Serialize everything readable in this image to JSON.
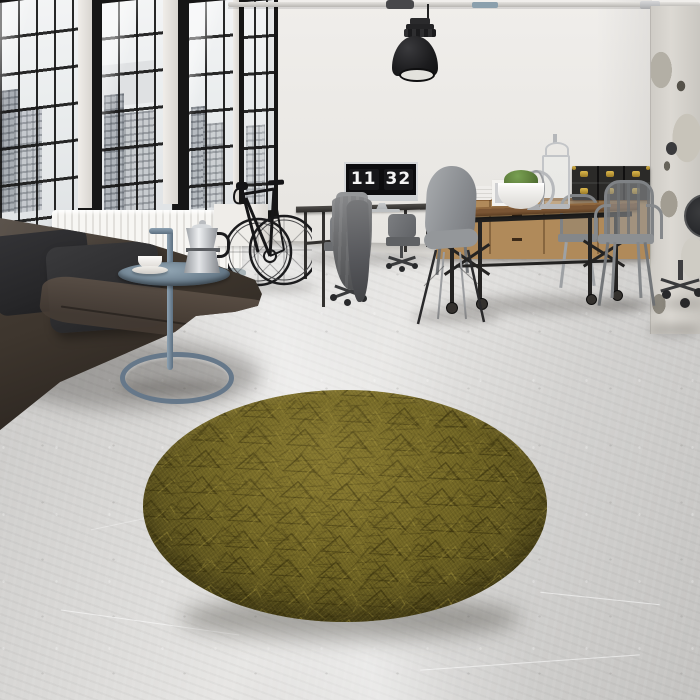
{
  "scene": {
    "setting": "industrial loft interior with concrete floor",
    "focal_item": "round olive-green textured rug",
    "time_on_screen": "11:32"
  },
  "clock": {
    "hours": "11",
    "minutes": "32"
  },
  "objects": [
    "factory windows with city view",
    "white radiator",
    "dark leather sofa with cushions",
    "blue-grey tubular side table",
    "moka pot",
    "espresso cup and saucer",
    "black road bicycle",
    "industrial pendant lamp",
    "ceiling pipework",
    "desk with monitor showing flip clock",
    "grey jacket draped over task chair",
    "office task chairs",
    "grey shell chair",
    "industrial dining table on casters",
    "grey metal cafe chairs",
    "wooden sideboard",
    "black storage trunks with brass clasps",
    "moss plant in white bowl",
    "silver lanterns",
    "distressed concrete pillar",
    "round olive textured rug",
    "polished concrete floor"
  ],
  "palette": {
    "wall": "#e8e6e2",
    "wall-shade": "#d7d5d1",
    "window-frame": "#161616",
    "sky": "#eef0f1",
    "building": "#b4b9bf",
    "radiator": "#f4f3f0",
    "floor": "#d8d7d5",
    "floor-dark": "#bfbebc",
    "sofa": "#3d352d",
    "sofa-dark": "#231e1a",
    "pillow": "#2c2c2e",
    "rug-base": "#6e6323",
    "rug-dark": "#4c4619",
    "rug-light": "#8b7d33",
    "side-table": "#7b90a1",
    "wood": "#b08a5a",
    "wood-dark": "#5d3f24",
    "metal-grey": "#85888b",
    "trunk": "#2b2a28",
    "brass": "#c7a13e",
    "lamp": "#1e1e20",
    "screen": "#0c0c0e",
    "digit": "#f4f4f4",
    "silver": "#c9cbce",
    "cloth": "#66676a",
    "moss": "#5f7f3c"
  }
}
